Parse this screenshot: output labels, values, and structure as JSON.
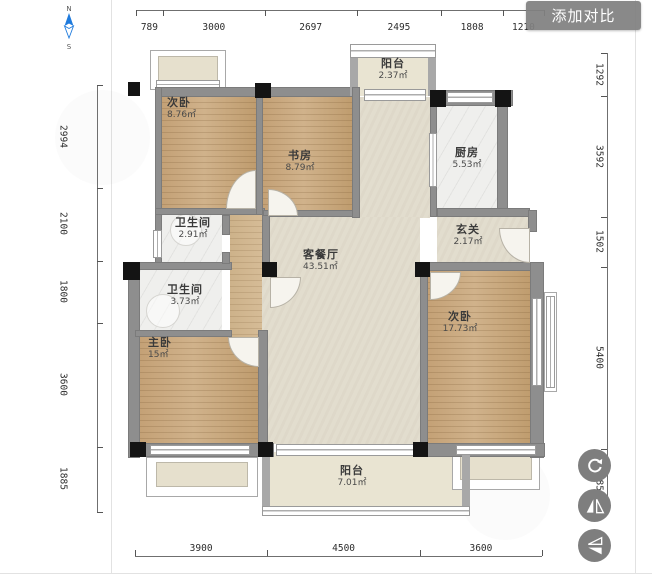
{
  "header": {
    "add_compare_label": "添加对比"
  },
  "compass": {
    "north": "N",
    "south": "S"
  },
  "rooms": [
    {
      "id": "bedroom-top-left",
      "name": "次卧",
      "area": "8.76㎡",
      "x": 167,
      "y": 97,
      "w": 70,
      "align": "left"
    },
    {
      "id": "study",
      "name": "书房",
      "area": "8.79㎡",
      "x": 268,
      "y": 150,
      "w": 64,
      "align": "center"
    },
    {
      "id": "balcony-top",
      "name": "阳台",
      "area": "2.37㎡",
      "x": 361,
      "y": 58,
      "w": 64,
      "align": "center"
    },
    {
      "id": "kitchen",
      "name": "厨房",
      "area": "5.53㎡",
      "x": 435,
      "y": 147,
      "w": 64,
      "align": "center"
    },
    {
      "id": "foyer",
      "name": "玄关",
      "area": "2.17㎡",
      "x": 436,
      "y": 224,
      "w": 64,
      "align": "center"
    },
    {
      "id": "bath-upper",
      "name": "卫生间",
      "area": "2.91㎡",
      "x": 160,
      "y": 217,
      "w": 66,
      "align": "center"
    },
    {
      "id": "bath-lower",
      "name": "卫生间",
      "area": "3.73㎡",
      "x": 152,
      "y": 284,
      "w": 66,
      "align": "center"
    },
    {
      "id": "living-dining",
      "name": "客餐厅",
      "area": "43.51㎡",
      "x": 303,
      "y": 249,
      "w": 74,
      "align": "left"
    },
    {
      "id": "master-bedroom",
      "name": "主卧",
      "area": "15㎡",
      "x": 148,
      "y": 337,
      "w": 64,
      "align": "left"
    },
    {
      "id": "bedroom-right",
      "name": "次卧",
      "area": "17.73㎡",
      "x": 428,
      "y": 311,
      "w": 64,
      "align": "center"
    },
    {
      "id": "balcony-bottom",
      "name": "阳台",
      "area": "7.01㎡",
      "x": 320,
      "y": 465,
      "w": 64,
      "align": "center"
    }
  ],
  "dimensions": {
    "top": [
      789,
      3000,
      2697,
      2495,
      1808,
      1210
    ],
    "bottom": [
      3900,
      4500,
      3600
    ],
    "left": [
      2994,
      2100,
      1800,
      3600,
      1885
    ],
    "right": [
      1292,
      3592,
      1502,
      5400,
      1885
    ]
  },
  "tools": [
    {
      "id": "rotate",
      "icon": "rotate-icon"
    },
    {
      "id": "flip-horizontal",
      "icon": "flip-horizontal-icon"
    },
    {
      "id": "flip-vertical",
      "icon": "flip-vertical-icon"
    }
  ]
}
